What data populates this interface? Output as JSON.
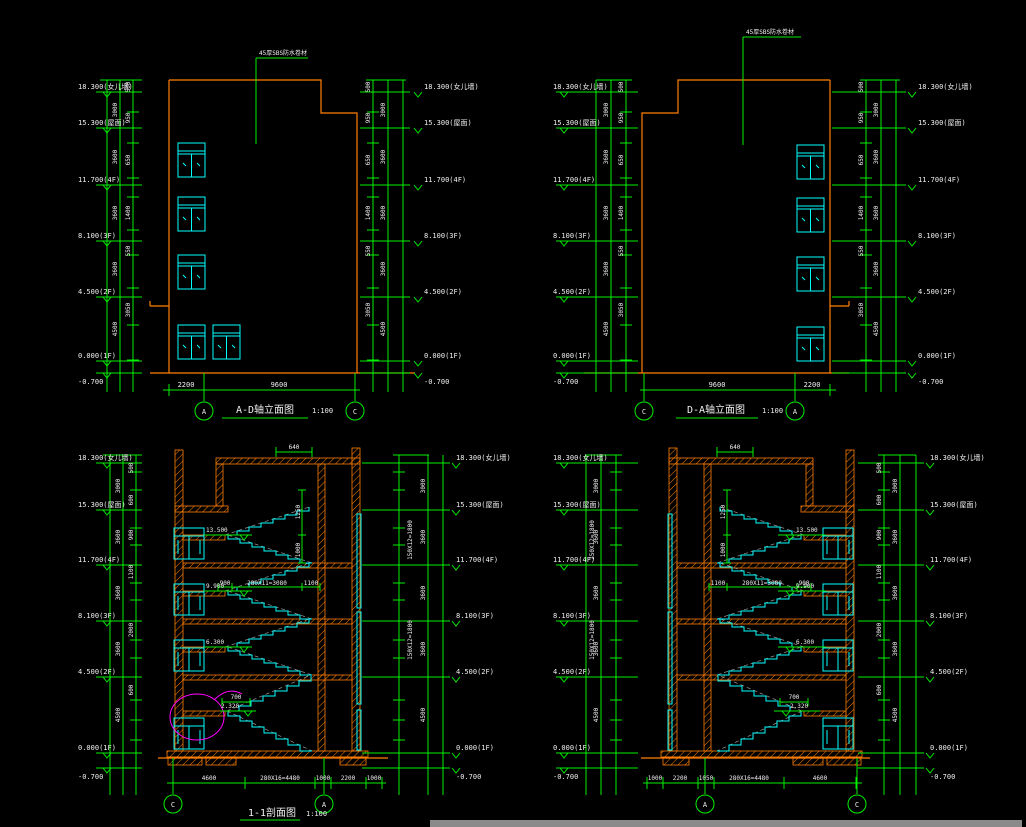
{
  "palette": {
    "background": "#000000",
    "dimension_green": "#00f000",
    "building_orange": "#ff7f00",
    "glazing_cyan": "#00ffff",
    "detail_magenta": "#ff00ff",
    "hidden_gray": "#9b9b9b",
    "text_white": "#f0f0f0",
    "scrollbar_gray": "#8a8a8a"
  },
  "levels": [
    "18.300(女儿墙)",
    "15.300(屋面)",
    "11.700(4F)",
    "8.100(3F)",
    "4.500(2F)",
    "0.000(1F)",
    "-0.700"
  ],
  "vchain": {
    "top": "500",
    "floors": [
      "3000",
      "3600",
      "3600",
      "3600",
      "4500"
    ],
    "bands": [
      "500",
      "950",
      "650",
      "1400",
      "550",
      "3050"
    ],
    "sbands": [
      "500",
      "600",
      "900",
      "1100",
      "2000",
      "600"
    ]
  },
  "elev1": {
    "title": "A-D轴立面图",
    "scale": "1:100",
    "note": "45厚SBS防水卷材",
    "bottom_dims": [
      "2200",
      "9600"
    ],
    "bubbles": [
      "A",
      "C"
    ]
  },
  "elev2": {
    "title": "D-A轴立面图",
    "scale": "1:100",
    "note": "45厚SBS防水卷材",
    "bottom_dims": [
      "9600",
      "2200"
    ],
    "bubbles": [
      "C",
      "A"
    ]
  },
  "sec1": {
    "title": "1-1剖面图",
    "scale": "1:100",
    "bubbles": [
      "C",
      "A"
    ],
    "bottom_dims": [
      "4600",
      "280X16=4480",
      "1000",
      "2200",
      "1000"
    ],
    "stair_dims": [
      "900",
      "280X11=3080",
      "1100"
    ],
    "landings": [
      "13.500",
      "9.900",
      "6.300",
      "2.320"
    ],
    "vdims": [
      "1250",
      "1000"
    ],
    "riser": "150X12=1800",
    "top_dim": "640",
    "head_dim": "700"
  },
  "sec2": {
    "bubbles": [
      "A",
      "C"
    ],
    "bottom_dims": [
      "1000",
      "2200",
      "1050",
      "280X16=4480",
      "4600"
    ],
    "stair_dims": [
      "1100",
      "280X11=3080",
      "900"
    ],
    "landings": [
      "13.500",
      "9.900",
      "6.300",
      "2.320"
    ],
    "vdims": [
      "1250",
      "1000"
    ],
    "riser": "150X12=1800",
    "top_dim": "640",
    "head_dim": "700"
  }
}
